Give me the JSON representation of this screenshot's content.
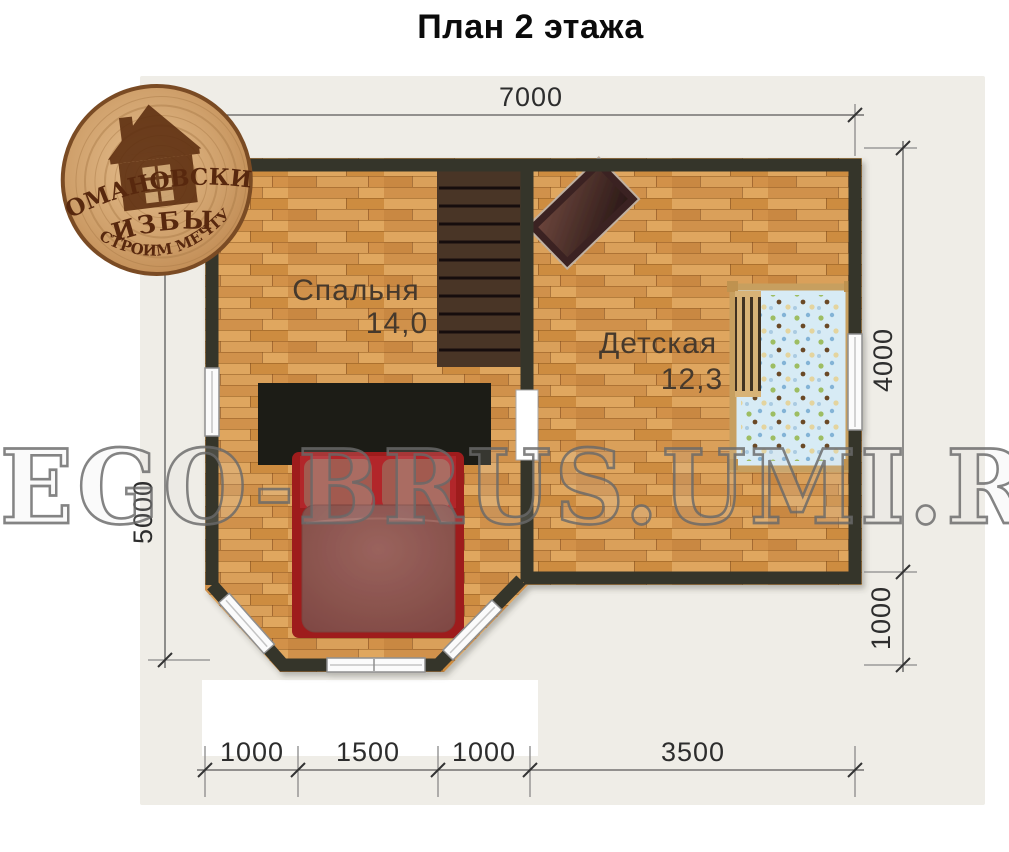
{
  "title": "План 2 этажа",
  "logo": {
    "name_line1": "РОМАНОВСКИЕ",
    "name_line2": "ИЗБЫ",
    "tagline": "СТРОИМ МЕЧТУ"
  },
  "watermark": "EGO-BRUS.UMI.RU",
  "plan": {
    "rooms": [
      {
        "name": "Спальня",
        "area": "14,0"
      },
      {
        "name": "Детская",
        "area": "12,3"
      }
    ],
    "dimensions": {
      "top": "7000",
      "left": "5000",
      "right_upper": "4000",
      "right_lower": "1000",
      "bottom": [
        "1000",
        "1500",
        "1000",
        "3500"
      ]
    }
  },
  "colors": {
    "wall": "#34342b",
    "floor_base": "#d79a52",
    "stairs": "#4a3526",
    "wardrobe": "#1c1c18",
    "bed_frame": "#9e1c1e",
    "bed_blanket": "#8d524d",
    "crib_mattress": "#d7ebf5",
    "crib_frame": "#c79f5e",
    "backdrop": "#efede7"
  }
}
